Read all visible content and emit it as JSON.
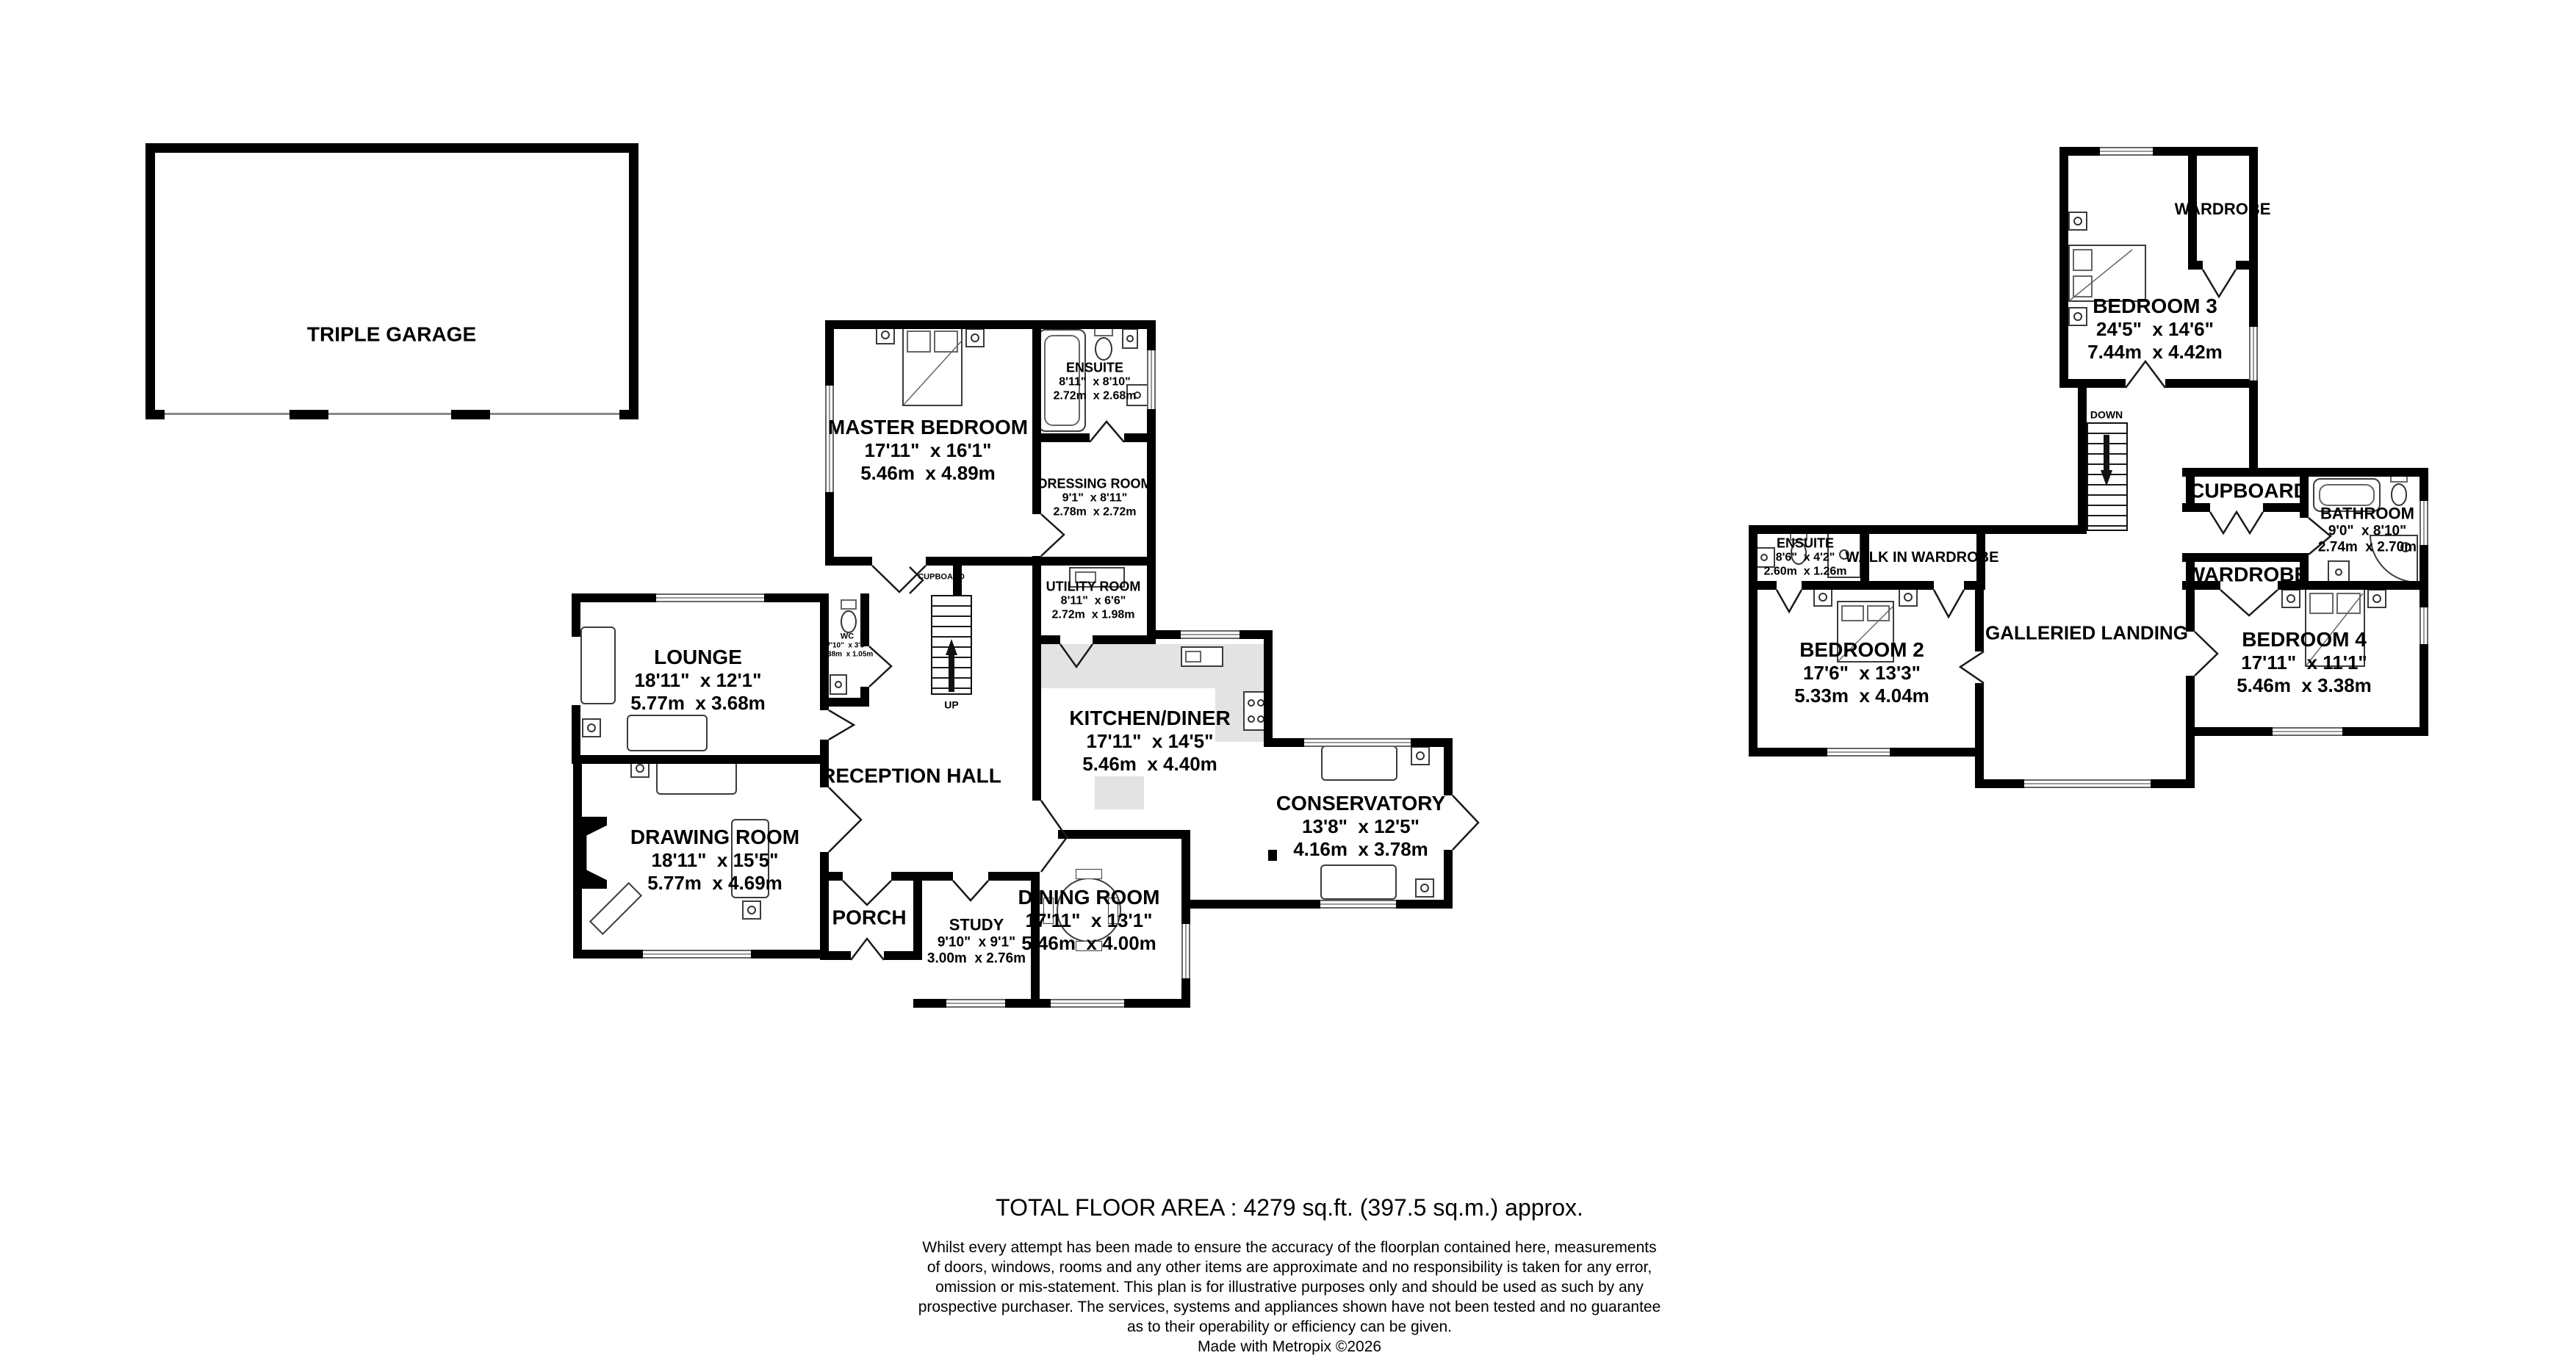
{
  "colors": {
    "wall": "#000000",
    "counter": "#e3e3e3",
    "background": "#ffffff"
  },
  "rooms": {
    "triple_garage": {
      "name": "TRIPLE GARAGE"
    },
    "master_bedroom": {
      "name": "MASTER BEDROOM",
      "dims_ft": "17'11\"  x 16'1\"",
      "dims_m": "5.46m  x 4.89m"
    },
    "ensuite_gf": {
      "name": "ENSUITE",
      "dims_ft": "8'11\"  x 8'10\"",
      "dims_m": "2.72m  x 2.68m"
    },
    "dressing_room": {
      "name": "DRESSING ROOM",
      "dims_ft": "9'1\"  x 8'11\"",
      "dims_m": "2.78m  x 2.72m"
    },
    "utility_room": {
      "name": "UTILITY ROOM",
      "dims_ft": "8'11\"  x 6'6\"",
      "dims_m": "2.72m  x 1.98m"
    },
    "kitchen_diner": {
      "name": "KITCHEN/DINER",
      "dims_ft": "17'11\"  x 14'5\"",
      "dims_m": "5.46m  x 4.40m"
    },
    "lounge": {
      "name": "LOUNGE",
      "dims_ft": "18'11\"  x 12'1\"",
      "dims_m": "5.77m  x 3.68m"
    },
    "wc": {
      "name": "WC",
      "dims_ft": "7'10\"  x 3'5\"",
      "dims_m": "2.38m  x 1.05m"
    },
    "reception_hall": {
      "name": "RECEPTION HALL"
    },
    "drawing_room": {
      "name": "DRAWING ROOM",
      "dims_ft": "18'11\"  x 15'5\"",
      "dims_m": "5.77m  x 4.69m"
    },
    "porch": {
      "name": "PORCH"
    },
    "study": {
      "name": "STUDY",
      "dims_ft": "9'10\"  x 9'1\"",
      "dims_m": "3.00m  x 2.76m"
    },
    "dining_room": {
      "name": "DINING ROOM",
      "dims_ft": "17'11\"  x 13'1\"",
      "dims_m": "5.46m  x 4.00m"
    },
    "conservatory": {
      "name": "CONSERVATORY",
      "dims_ft": "13'8\"  x 12'5\"",
      "dims_m": "4.16m  x 3.78m"
    },
    "cupboard_gf": {
      "name": "CUPBOARD"
    },
    "bedroom3": {
      "name": "BEDROOM 3",
      "dims_ft": "24'5\"  x 14'6\"",
      "dims_m": "7.44m  x 4.42m"
    },
    "wardrobe3": {
      "name": "WARDROBE"
    },
    "cupboard_ff": {
      "name": "CUPBOARD"
    },
    "bathroom": {
      "name": "BATHROOM",
      "dims_ft": "9'0\"  x 8'10\"",
      "dims_m": "2.74m  x 2.70m"
    },
    "ensuite_ff": {
      "name": "ENSUITE",
      "dims_ft": "8'6\"  x 4'2\"",
      "dims_m": "2.60m  x 1.26m"
    },
    "walk_in_wardrobe": {
      "name": "WALK IN WARDROBE"
    },
    "bedroom2": {
      "name": "BEDROOM 2",
      "dims_ft": "17'6\"  x 13'3\"",
      "dims_m": "5.33m  x 4.04m"
    },
    "galleried_landing": {
      "name": "GALLERIED LANDING"
    },
    "wardrobe4": {
      "name": "WARDROBE"
    },
    "bedroom4": {
      "name": "BEDROOM 4",
      "dims_ft": "17'11\"  x 11'1\"",
      "dims_m": "5.46m  x 3.38m"
    }
  },
  "stairs": {
    "up": "UP",
    "down": "DOWN"
  },
  "footer": {
    "total": "TOTAL FLOOR AREA : 4279 sq.ft. (397.5 sq.m.) approx.",
    "disclaimer_lines": [
      "Whilst every attempt has been made to ensure the accuracy of the floorplan contained here, measurements",
      "of doors, windows, rooms and any other items are approximate and no responsibility is taken for any error,",
      "omission or mis-statement. This plan is for illustrative purposes only and should be used as such by any",
      "prospective purchaser. The services, systems and appliances shown have not been tested and no guarantee",
      "as to their operability or efficiency can be given."
    ],
    "credit": "Made with Metropix ©2026"
  }
}
